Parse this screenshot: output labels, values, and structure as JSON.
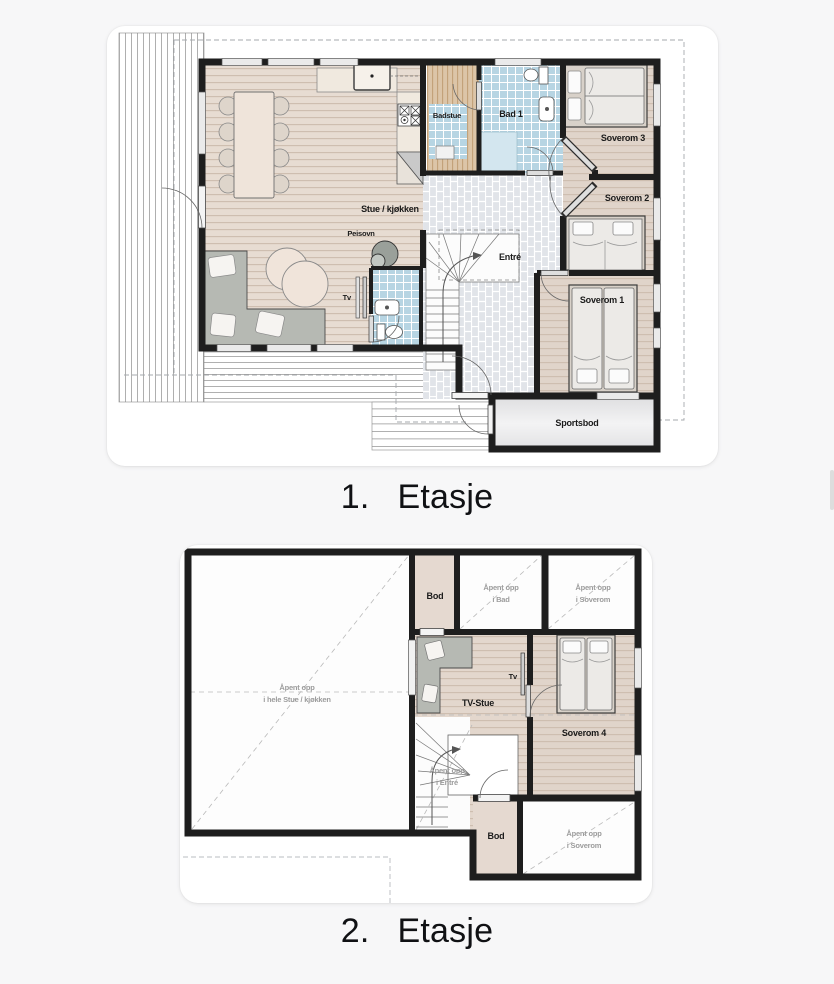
{
  "colors": {
    "page_bg": "#f7f7f8",
    "card_bg": "#ffffff",
    "wall": "#1e1e1e",
    "wood_living": "#e7dcd2",
    "wood_bedroom": "#e0d4ca",
    "tile_blue": "#b7d5e3",
    "tile_entry": "#e1e4e9",
    "sauna_wood": "#dcc5a8",
    "furniture_gray": "#b6b9b3",
    "storage_gray": "#e6e6e8",
    "open_area": "#fdfdfd",
    "label_dark": "#1b1b1b",
    "label_gray": "#9c9c9c"
  },
  "floor1": {
    "caption": {
      "number": "1.",
      "name": "Etasje"
    },
    "labels": {
      "stue": "Stue / kjøkken",
      "badstue": "Badstue",
      "bad1": "Bad 1",
      "soverom3": "Soverom 3",
      "soverom2": "Soverom 2",
      "soverom1": "Soverom 1",
      "entre": "Entré",
      "sportsbod": "Sportsbod",
      "peisovn": "Peisovn",
      "tv": "Tv"
    }
  },
  "floor2": {
    "caption": {
      "number": "2.",
      "name": "Etasje"
    },
    "labels": {
      "bod_top": "Bod",
      "apent_bad_1": "Åpent opp",
      "apent_bad_2": "i Bad",
      "apent_sov_top_1": "Åpent opp",
      "apent_sov_top_2": "i Soverom",
      "tv_stue": "TV-Stue",
      "tv": "Tv",
      "soverom4": "Soverom 4",
      "apent_hele_1": "Åpent opp",
      "apent_hele_2": "i hele Stue / kjøkken",
      "apent_entre_1": "Åpent opp",
      "apent_entre_2": "i Entré",
      "bod_bottom": "Bod",
      "apent_sov_btm_1": "Åpent opp",
      "apent_sov_btm_2": "i Soverom"
    }
  }
}
